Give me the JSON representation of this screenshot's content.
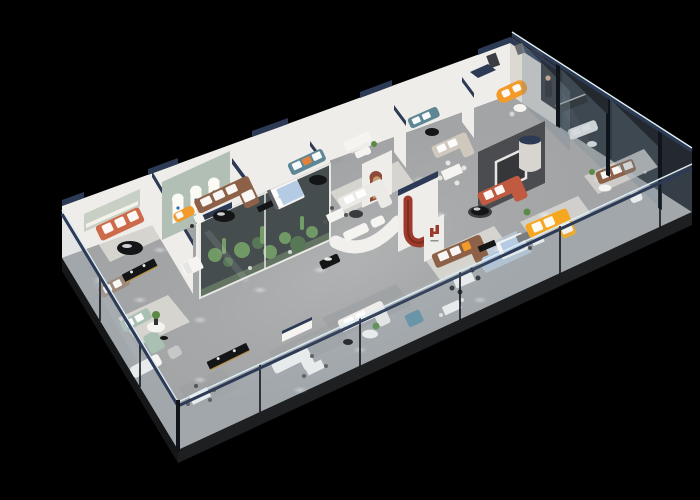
{
  "scene": {
    "title": "3D isometric cutaway render of a furniture showroom floor plan on a black background",
    "view": "high-angle dollhouse view, long axis running lower-left to upper-right",
    "background": "#000000"
  },
  "palette": {
    "bg": "#000000",
    "floor": "#a2a4a5",
    "floorLight": "#b6b7b8",
    "slab": "#1e1f21",
    "wallWhite": "#efede9",
    "wallShade": "#dcd8d2",
    "navyCap": "#2c3a55",
    "glassBright": "#dcecf4",
    "glassFrame": "#10151c",
    "charcoal": "#4a4c4f",
    "archWall": "#b2bfb4",
    "archGlow": "#fbfbf4",
    "coral": "#cd6a4a",
    "redFeature": "#9c3a2b",
    "terracotta": "#c05a41",
    "orange": "#f29a2a",
    "yellow": "#f5a71f",
    "brown": "#8d6148",
    "taupe": "#9c8a7d",
    "teal": "#5e8795",
    "tealCube": "#5f8fa0",
    "sage": "#a9c0b2",
    "blueBed": "#b5cbe4",
    "rugBlue": "#b9cadb",
    "plant": "#5b8a46",
    "plantDark": "#3c5e33",
    "blackFurn": "#141517",
    "gold": "#c9a050",
    "white": "#f5f4f1",
    "rugLight": "#d6d4cf",
    "rugGrey": "#9b9ea0",
    "rugDark": "#66625c",
    "skin": "#e8b48f",
    "blueLogo": "#2f6fb3"
  },
  "zones": [
    {
      "id": "coral-sofa-room",
      "desc": "white room with coral sofa, black round coffee table, shelf niche"
    },
    {
      "id": "arched-display-wall",
      "desc": "sage wall with three glowing arched niches and blue brand marks"
    },
    {
      "id": "brown-sectional-area",
      "desc": "brown leather sectional with black oval coffee table on dark rug"
    },
    {
      "id": "blue-bedroom",
      "desc": "bed with light blue bedding on blue rug with black media console"
    },
    {
      "id": "teal-sofa-lounges",
      "desc": "teal sofas with white and orange cushions"
    },
    {
      "id": "terrarium-display",
      "desc": "glass case planted with cacti and greenery, navy capped"
    },
    {
      "id": "media-feature-wall",
      "desc": "charcoal wall with white framed screen and navy-topped cylinder"
    },
    {
      "id": "red-slide-feature",
      "desc": "red J-shaped sculptural channel on white partition"
    },
    {
      "id": "red-h-logo-pillar",
      "desc": "white pillar with red brand mark"
    },
    {
      "id": "terracotta-sofa-lounge",
      "desc": "terracotta sectional facing black oval table"
    },
    {
      "id": "yellow-sofa-room",
      "desc": "bright amber sectional with white cushions"
    },
    {
      "id": "brown-leather-suite",
      "desc": "brown leather sofa and dining set behind smoked glass"
    },
    {
      "id": "sage-green-lounge",
      "desc": "sage sofas around white pedestal table with flowers"
    },
    {
      "id": "dining-sets",
      "desc": "white dining tables with chairs on grey rugs"
    },
    {
      "id": "corner-reception",
      "desc": "corner room with curved orange sofa and promo standee figure"
    },
    {
      "id": "glass-perimeter",
      "desc": "glass balustrade with navy top rail along the front edges"
    }
  ],
  "brand_marks": [
    {
      "name": "arch-logo-blue-icon"
    },
    {
      "name": "h-logo-red-icon"
    },
    {
      "name": "promo-standee-figure-icon"
    }
  ]
}
